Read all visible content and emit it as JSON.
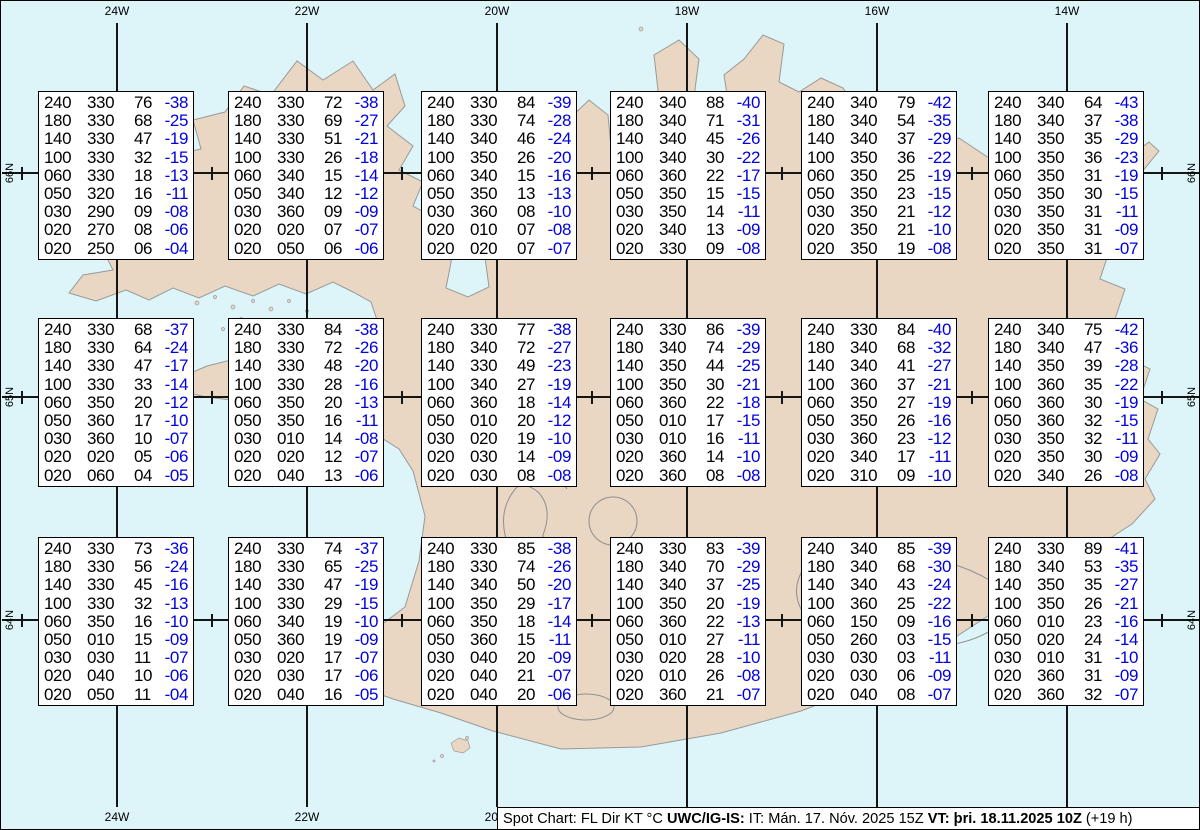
{
  "map_title": "Spot Chart Iceland",
  "columns": [
    "FL",
    "Dir",
    "KT",
    "°C"
  ],
  "colors": {
    "ocean": "#ddf5f9",
    "land": "#e9d7c3",
    "coastline": "#999999",
    "grid": "#151515",
    "box_bg": "#ffffff",
    "text": "#000000",
    "temperature": "#0000e0"
  },
  "status_bar": {
    "prefix": "Spot Chart: FL Dir KT °C",
    "source": "UWC/IG-IS:",
    "issue_time": "IT: Mán. 17. Nóv. 2025 15Z",
    "valid_time": "VT: þri. 18.11.2025 10Z",
    "offset": "(+19 h)"
  },
  "graticule": {
    "meridians": [
      {
        "label": "24W",
        "x": 116
      },
      {
        "label": "22W",
        "x": 306
      },
      {
        "label": "20W",
        "x": 496
      },
      {
        "label": "18W",
        "x": 686
      },
      {
        "label": "16W",
        "x": 876
      },
      {
        "label": "14W",
        "x": 1066
      }
    ],
    "parallels": [
      {
        "label": "66N",
        "y": 172
      },
      {
        "label": "65N",
        "y": 396
      },
      {
        "label": "64N",
        "y": 619
      }
    ],
    "minor_tick_x": [
      21,
      211,
      401,
      591,
      781,
      971,
      1161
    ]
  },
  "boxes": [
    {
      "x": 37,
      "y": 90,
      "rows": [
        [
          "240",
          "330",
          "76",
          "-38"
        ],
        [
          "180",
          "330",
          "68",
          "-25"
        ],
        [
          "140",
          "330",
          "47",
          "-19"
        ],
        [
          "100",
          "330",
          "32",
          "-15"
        ],
        [
          "060",
          "330",
          "18",
          "-13"
        ],
        [
          "050",
          "320",
          "16",
          "-11"
        ],
        [
          "030",
          "290",
          "09",
          "-08"
        ],
        [
          "020",
          "270",
          "08",
          "-06"
        ],
        [
          "020",
          "250",
          "06",
          "-04"
        ]
      ]
    },
    {
      "x": 227,
      "y": 90,
      "rows": [
        [
          "240",
          "330",
          "72",
          "-38"
        ],
        [
          "180",
          "330",
          "69",
          "-27"
        ],
        [
          "140",
          "330",
          "51",
          "-21"
        ],
        [
          "100",
          "330",
          "26",
          "-18"
        ],
        [
          "060",
          "340",
          "15",
          "-14"
        ],
        [
          "050",
          "340",
          "12",
          "-12"
        ],
        [
          "030",
          "360",
          "09",
          "-09"
        ],
        [
          "020",
          "020",
          "07",
          "-07"
        ],
        [
          "020",
          "050",
          "06",
          "-06"
        ]
      ]
    },
    {
      "x": 420,
      "y": 90,
      "rows": [
        [
          "240",
          "330",
          "84",
          "-39"
        ],
        [
          "180",
          "330",
          "74",
          "-28"
        ],
        [
          "140",
          "340",
          "46",
          "-24"
        ],
        [
          "100",
          "350",
          "26",
          "-20"
        ],
        [
          "060",
          "340",
          "15",
          "-16"
        ],
        [
          "050",
          "350",
          "13",
          "-13"
        ],
        [
          "030",
          "360",
          "08",
          "-10"
        ],
        [
          "020",
          "010",
          "07",
          "-08"
        ],
        [
          "020",
          "020",
          "07",
          "-07"
        ]
      ]
    },
    {
      "x": 609,
      "y": 90,
      "rows": [
        [
          "240",
          "340",
          "88",
          "-40"
        ],
        [
          "180",
          "340",
          "71",
          "-31"
        ],
        [
          "140",
          "340",
          "45",
          "-26"
        ],
        [
          "100",
          "340",
          "30",
          "-22"
        ],
        [
          "060",
          "360",
          "22",
          "-17"
        ],
        [
          "050",
          "350",
          "15",
          "-15"
        ],
        [
          "030",
          "350",
          "14",
          "-11"
        ],
        [
          "020",
          "340",
          "13",
          "-09"
        ],
        [
          "020",
          "330",
          "09",
          "-08"
        ]
      ]
    },
    {
      "x": 800,
      "y": 90,
      "rows": [
        [
          "240",
          "340",
          "79",
          "-42"
        ],
        [
          "180",
          "340",
          "54",
          "-35"
        ],
        [
          "140",
          "340",
          "37",
          "-29"
        ],
        [
          "100",
          "350",
          "36",
          "-22"
        ],
        [
          "060",
          "350",
          "25",
          "-19"
        ],
        [
          "050",
          "350",
          "23",
          "-15"
        ],
        [
          "030",
          "350",
          "21",
          "-12"
        ],
        [
          "020",
          "350",
          "21",
          "-10"
        ],
        [
          "020",
          "350",
          "19",
          "-08"
        ]
      ]
    },
    {
      "x": 987,
      "y": 90,
      "rows": [
        [
          "240",
          "340",
          "64",
          "-43"
        ],
        [
          "180",
          "340",
          "37",
          "-38"
        ],
        [
          "140",
          "350",
          "35",
          "-29"
        ],
        [
          "100",
          "350",
          "36",
          "-23"
        ],
        [
          "060",
          "350",
          "31",
          "-19"
        ],
        [
          "050",
          "350",
          "30",
          "-15"
        ],
        [
          "030",
          "350",
          "31",
          "-11"
        ],
        [
          "020",
          "350",
          "31",
          "-09"
        ],
        [
          "020",
          "350",
          "31",
          "-07"
        ]
      ]
    },
    {
      "x": 37,
      "y": 317,
      "rows": [
        [
          "240",
          "330",
          "68",
          "-37"
        ],
        [
          "180",
          "330",
          "64",
          "-24"
        ],
        [
          "140",
          "330",
          "47",
          "-17"
        ],
        [
          "100",
          "330",
          "33",
          "-14"
        ],
        [
          "060",
          "350",
          "20",
          "-12"
        ],
        [
          "050",
          "360",
          "17",
          "-10"
        ],
        [
          "030",
          "360",
          "10",
          "-07"
        ],
        [
          "020",
          "020",
          "05",
          "-06"
        ],
        [
          "020",
          "060",
          "04",
          "-05"
        ]
      ]
    },
    {
      "x": 227,
      "y": 317,
      "rows": [
        [
          "240",
          "330",
          "84",
          "-38"
        ],
        [
          "180",
          "330",
          "72",
          "-26"
        ],
        [
          "140",
          "330",
          "48",
          "-20"
        ],
        [
          "100",
          "330",
          "28",
          "-16"
        ],
        [
          "060",
          "350",
          "20",
          "-13"
        ],
        [
          "050",
          "350",
          "16",
          "-11"
        ],
        [
          "030",
          "010",
          "14",
          "-08"
        ],
        [
          "020",
          "020",
          "12",
          "-07"
        ],
        [
          "020",
          "040",
          "13",
          "-06"
        ]
      ]
    },
    {
      "x": 420,
      "y": 317,
      "rows": [
        [
          "240",
          "330",
          "77",
          "-38"
        ],
        [
          "180",
          "340",
          "72",
          "-27"
        ],
        [
          "140",
          "330",
          "49",
          "-23"
        ],
        [
          "100",
          "340",
          "27",
          "-19"
        ],
        [
          "060",
          "360",
          "18",
          "-14"
        ],
        [
          "050",
          "010",
          "20",
          "-12"
        ],
        [
          "030",
          "020",
          "19",
          "-10"
        ],
        [
          "020",
          "030",
          "14",
          "-09"
        ],
        [
          "020",
          "030",
          "08",
          "-08"
        ]
      ]
    },
    {
      "x": 609,
      "y": 317,
      "rows": [
        [
          "240",
          "330",
          "86",
          "-39"
        ],
        [
          "180",
          "340",
          "74",
          "-29"
        ],
        [
          "140",
          "350",
          "44",
          "-25"
        ],
        [
          "100",
          "350",
          "30",
          "-21"
        ],
        [
          "060",
          "360",
          "22",
          "-18"
        ],
        [
          "050",
          "010",
          "17",
          "-15"
        ],
        [
          "030",
          "010",
          "16",
          "-11"
        ],
        [
          "020",
          "360",
          "14",
          "-10"
        ],
        [
          "020",
          "360",
          "08",
          "-08"
        ]
      ]
    },
    {
      "x": 800,
      "y": 317,
      "rows": [
        [
          "240",
          "330",
          "84",
          "-40"
        ],
        [
          "180",
          "340",
          "68",
          "-32"
        ],
        [
          "140",
          "340",
          "41",
          "-27"
        ],
        [
          "100",
          "360",
          "37",
          "-21"
        ],
        [
          "060",
          "350",
          "27",
          "-19"
        ],
        [
          "050",
          "350",
          "26",
          "-16"
        ],
        [
          "030",
          "360",
          "23",
          "-12"
        ],
        [
          "020",
          "340",
          "17",
          "-11"
        ],
        [
          "020",
          "310",
          "09",
          "-10"
        ]
      ]
    },
    {
      "x": 987,
      "y": 317,
      "rows": [
        [
          "240",
          "340",
          "75",
          "-42"
        ],
        [
          "180",
          "340",
          "47",
          "-36"
        ],
        [
          "140",
          "350",
          "39",
          "-28"
        ],
        [
          "100",
          "360",
          "35",
          "-22"
        ],
        [
          "060",
          "360",
          "30",
          "-19"
        ],
        [
          "050",
          "360",
          "32",
          "-15"
        ],
        [
          "030",
          "350",
          "32",
          "-11"
        ],
        [
          "020",
          "350",
          "30",
          "-09"
        ],
        [
          "020",
          "340",
          "26",
          "-08"
        ]
      ]
    },
    {
      "x": 37,
      "y": 536,
      "rows": [
        [
          "240",
          "330",
          "73",
          "-36"
        ],
        [
          "180",
          "330",
          "56",
          "-24"
        ],
        [
          "140",
          "330",
          "45",
          "-16"
        ],
        [
          "100",
          "330",
          "32",
          "-13"
        ],
        [
          "060",
          "350",
          "16",
          "-10"
        ],
        [
          "050",
          "010",
          "15",
          "-09"
        ],
        [
          "030",
          "030",
          "11",
          "-07"
        ],
        [
          "020",
          "040",
          "10",
          "-06"
        ],
        [
          "020",
          "050",
          "11",
          "-04"
        ]
      ]
    },
    {
      "x": 227,
      "y": 536,
      "rows": [
        [
          "240",
          "330",
          "74",
          "-37"
        ],
        [
          "180",
          "330",
          "65",
          "-25"
        ],
        [
          "140",
          "330",
          "47",
          "-19"
        ],
        [
          "100",
          "330",
          "29",
          "-15"
        ],
        [
          "060",
          "340",
          "19",
          "-10"
        ],
        [
          "050",
          "360",
          "19",
          "-09"
        ],
        [
          "030",
          "020",
          "17",
          "-07"
        ],
        [
          "020",
          "030",
          "17",
          "-06"
        ],
        [
          "020",
          "040",
          "16",
          "-05"
        ]
      ]
    },
    {
      "x": 420,
      "y": 536,
      "rows": [
        [
          "240",
          "330",
          "85",
          "-38"
        ],
        [
          "180",
          "330",
          "74",
          "-26"
        ],
        [
          "140",
          "340",
          "50",
          "-20"
        ],
        [
          "100",
          "350",
          "29",
          "-17"
        ],
        [
          "060",
          "350",
          "18",
          "-14"
        ],
        [
          "050",
          "360",
          "15",
          "-11"
        ],
        [
          "030",
          "040",
          "20",
          "-09"
        ],
        [
          "020",
          "040",
          "21",
          "-07"
        ],
        [
          "020",
          "040",
          "20",
          "-06"
        ]
      ]
    },
    {
      "x": 609,
      "y": 536,
      "rows": [
        [
          "240",
          "330",
          "83",
          "-39"
        ],
        [
          "180",
          "340",
          "70",
          "-29"
        ],
        [
          "140",
          "340",
          "37",
          "-25"
        ],
        [
          "100",
          "350",
          "20",
          "-19"
        ],
        [
          "060",
          "360",
          "22",
          "-13"
        ],
        [
          "050",
          "010",
          "27",
          "-11"
        ],
        [
          "030",
          "020",
          "28",
          "-10"
        ],
        [
          "020",
          "010",
          "26",
          "-08"
        ],
        [
          "020",
          "360",
          "21",
          "-07"
        ]
      ]
    },
    {
      "x": 800,
      "y": 536,
      "rows": [
        [
          "240",
          "340",
          "85",
          "-39"
        ],
        [
          "180",
          "340",
          "68",
          "-30"
        ],
        [
          "140",
          "340",
          "43",
          "-24"
        ],
        [
          "100",
          "360",
          "25",
          "-22"
        ],
        [
          "060",
          "150",
          "09",
          "-16"
        ],
        [
          "050",
          "260",
          "03",
          "-15"
        ],
        [
          "030",
          "030",
          "03",
          "-11"
        ],
        [
          "020",
          "030",
          "06",
          "-09"
        ],
        [
          "020",
          "040",
          "08",
          "-07"
        ]
      ]
    },
    {
      "x": 987,
      "y": 536,
      "rows": [
        [
          "240",
          "330",
          "89",
          "-41"
        ],
        [
          "180",
          "340",
          "53",
          "-35"
        ],
        [
          "140",
          "350",
          "35",
          "-27"
        ],
        [
          "100",
          "350",
          "26",
          "-21"
        ],
        [
          "060",
          "010",
          "23",
          "-16"
        ],
        [
          "050",
          "020",
          "24",
          "-14"
        ],
        [
          "030",
          "010",
          "31",
          "-10"
        ],
        [
          "020",
          "360",
          "31",
          "-09"
        ],
        [
          "020",
          "360",
          "32",
          "-07"
        ]
      ]
    }
  ]
}
